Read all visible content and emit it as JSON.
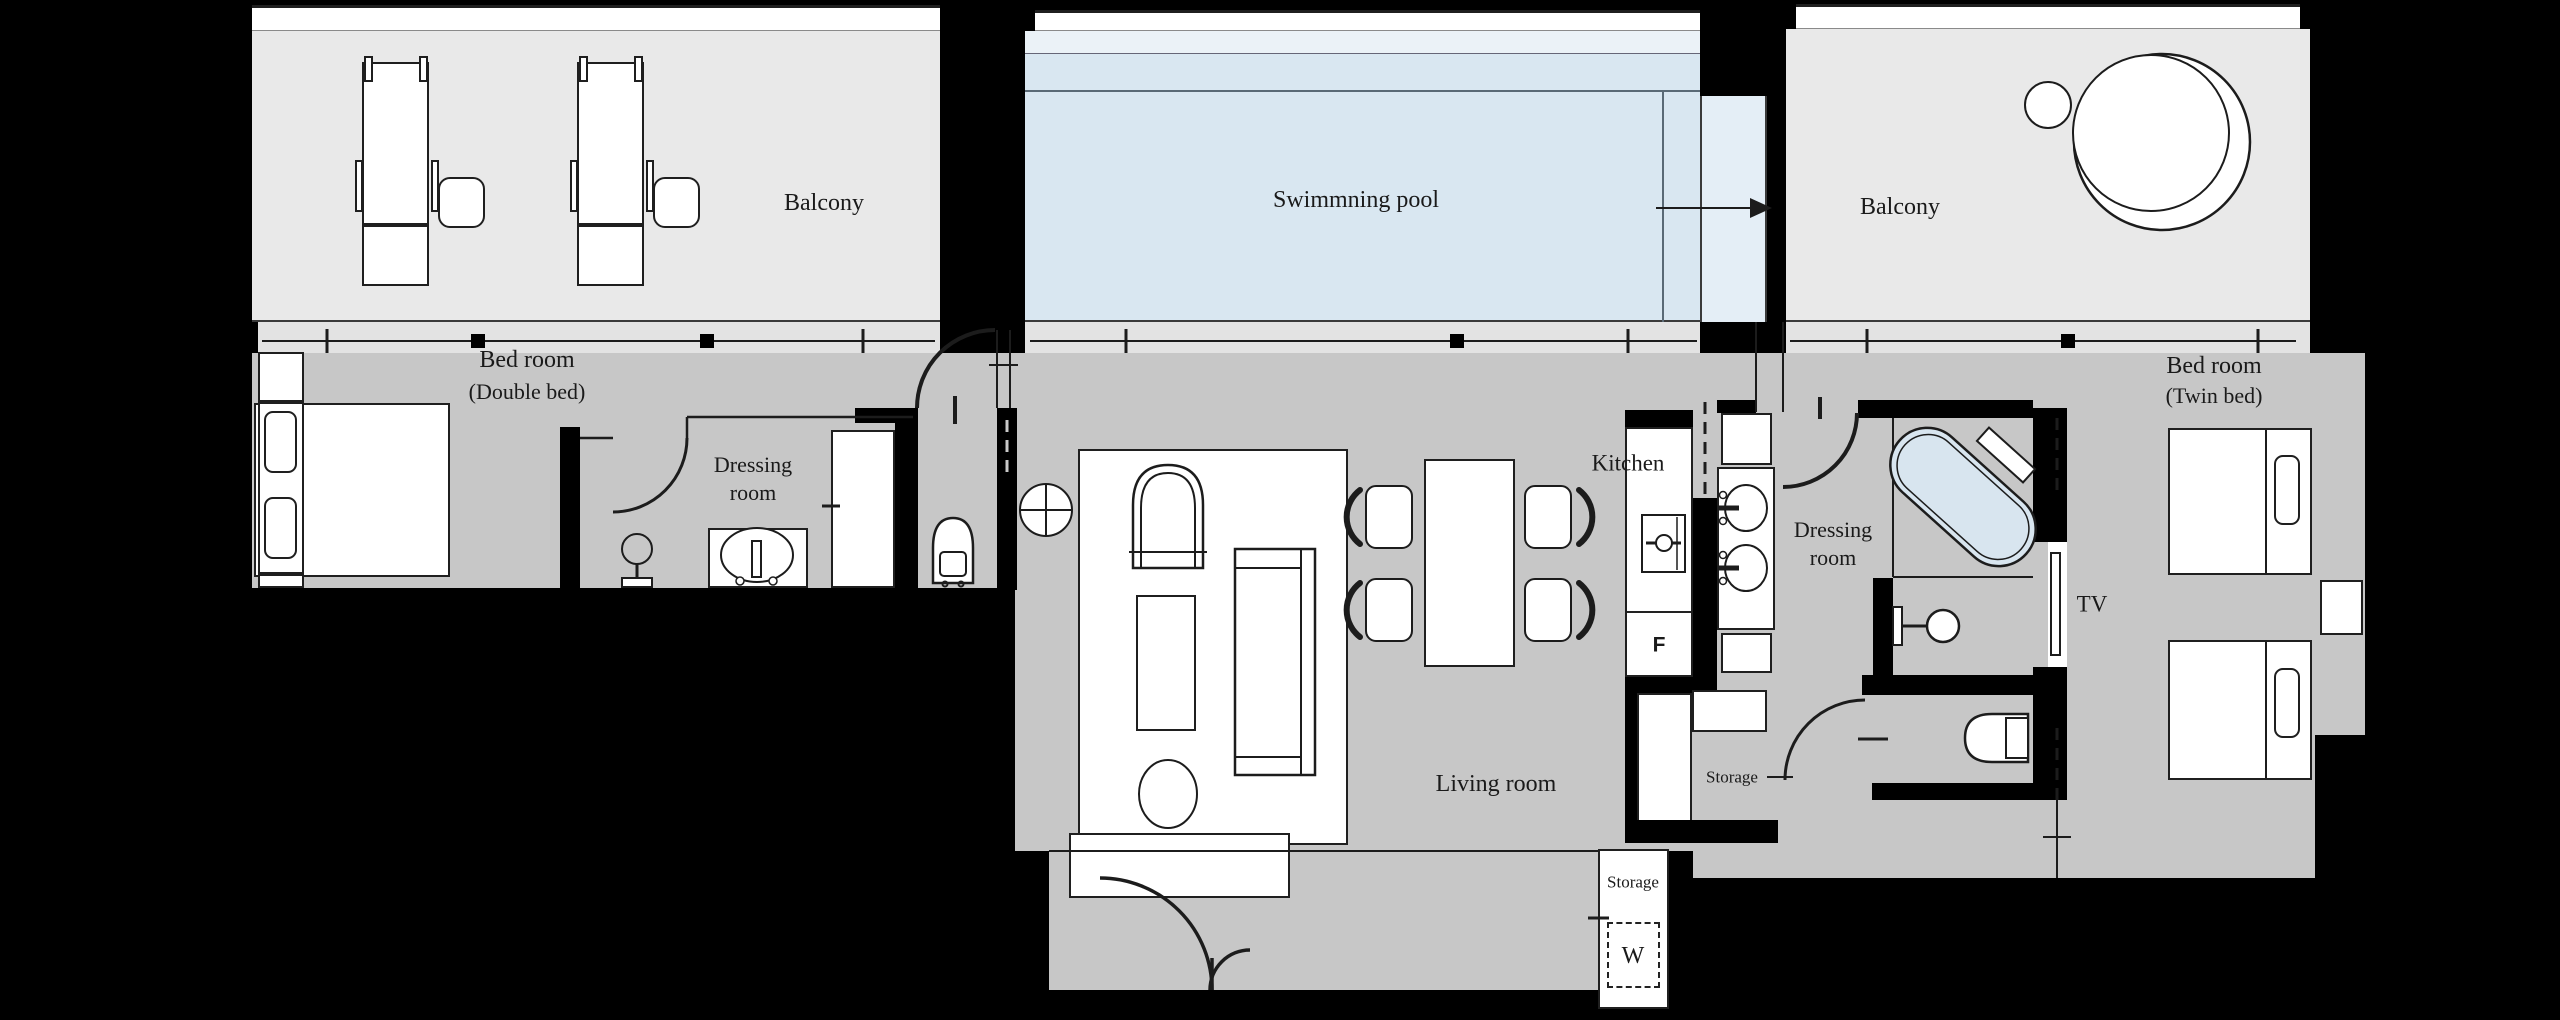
{
  "scene": {
    "type": "hotel-suite-floor-plan"
  },
  "labels": {
    "balcony_left": "Balcony",
    "swimming_pool": "Swimmning pool",
    "balcony_right": "Balcony",
    "bedroom_left_line1": "Bed room",
    "bedroom_left_line2": "(Double bed)",
    "dressing_left_line1": "Dressing",
    "dressing_left_line2": "room",
    "kitchen": "Kitchen",
    "living_room": "Living room",
    "dressing_right_line1": "Dressing",
    "dressing_right_line2": "room",
    "bedroom_right_line1": "Bed room",
    "bedroom_right_line2": "(Twin bed)",
    "storage_center": "Storage",
    "storage_bottom": "Storage",
    "tv": "TV",
    "fridge_marker": "F",
    "washer_marker": "W"
  },
  "colors": {
    "background": "#000000",
    "wall": "#000000",
    "room_floor": "#c7c7c7",
    "balcony_floor": "#e9e9e9",
    "window_band": "#e3e3e3",
    "pool_water": "#d9e7f1",
    "pool_deck_strip": "#ebf2f7",
    "pool_channel": "#e4eef6",
    "bathtub_water": "#d8e5ef",
    "furniture_fill": "#ffffff",
    "line": "#1c1c1c",
    "text": "#1a1a1a"
  }
}
